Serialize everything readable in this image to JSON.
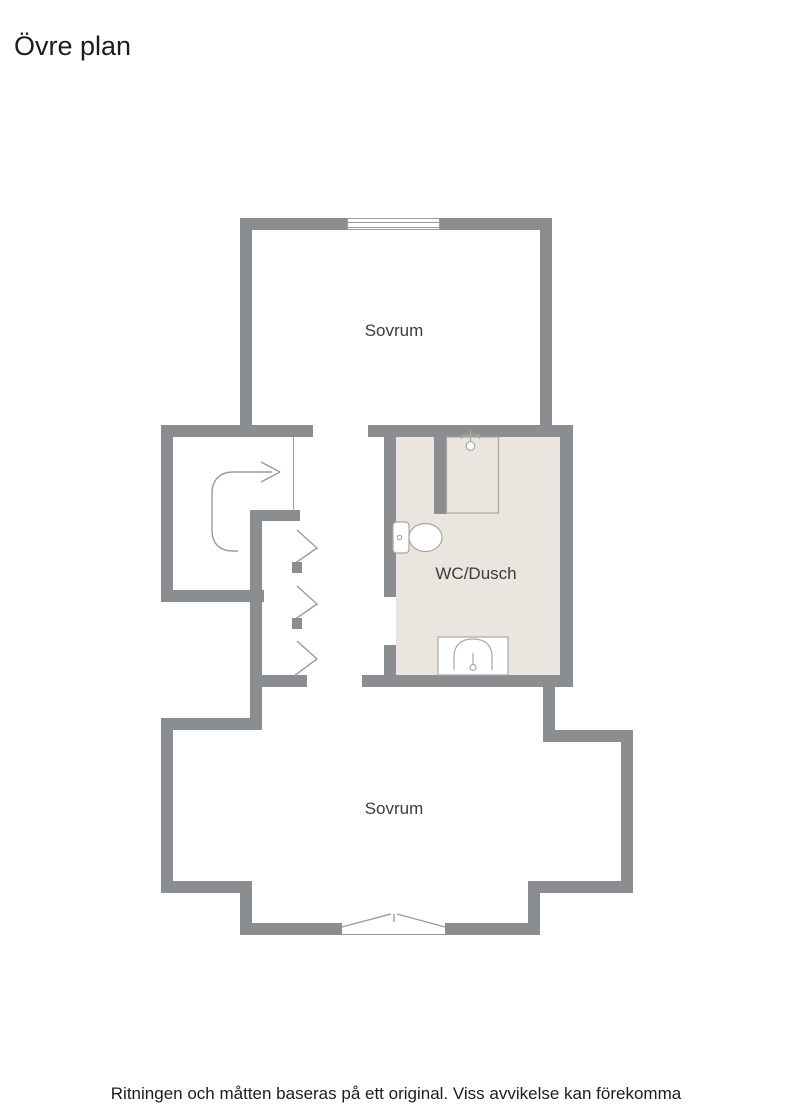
{
  "page": {
    "title": "Övre plan",
    "footer": "Ritningen och måtten baseras på ett original. Viss avvikelse kan förekomma"
  },
  "rooms": {
    "bedroom_top": {
      "label": "Sovrum"
    },
    "bathroom": {
      "label": "WC/Dusch"
    },
    "bedroom_bottom": {
      "label": "Sovrum"
    }
  },
  "symbols": {
    "stair_arrow": "curved-arrow-right (stair direction)",
    "wardrobe_doors": "three chevron door symbols with pivot squares",
    "window_top": "double-line window in top wall",
    "opening_bottom": "angled double-leaf opening in bottom wall",
    "toilet": "toilet-icon",
    "shower": "shower-head-icon",
    "sink": "sink-icon"
  },
  "colors": {
    "wall": "#8a8e91",
    "bathroom_floor": "#eae5de",
    "symbol_line": "#9b9b99",
    "fixture_stroke": "#a8a7a3",
    "room_label_text": "#3c3c3c",
    "heading_text": "#1c1c1c"
  }
}
